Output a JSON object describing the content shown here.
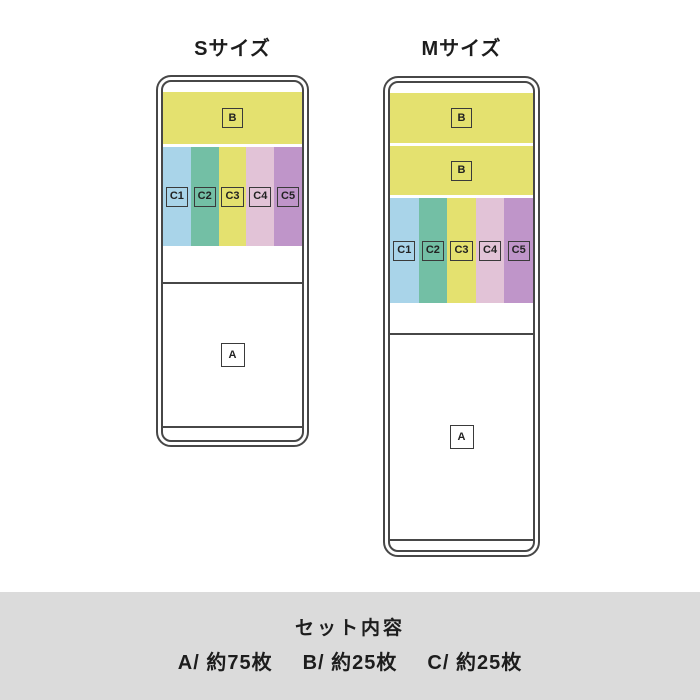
{
  "titles": {
    "s": "Sサイズ",
    "m": "Mサイズ"
  },
  "tags": {
    "a": "A",
    "b": "B",
    "c": [
      "C1",
      "C2",
      "C3",
      "C4",
      "C5"
    ]
  },
  "colors": {
    "band_yellow": "#e4e16f",
    "c1": "#a9d4e9",
    "c2": "#73bfa5",
    "c3": "#e4e16f",
    "c4": "#e2c3d7",
    "c5": "#bf95c9",
    "outline": "#474747",
    "footer_bg": "#dbdbdb"
  },
  "footer": {
    "heading": "セット内容",
    "items": [
      "A/ 約75枚",
      "B/ 約25枚",
      "C/ 約25枚"
    ]
  }
}
